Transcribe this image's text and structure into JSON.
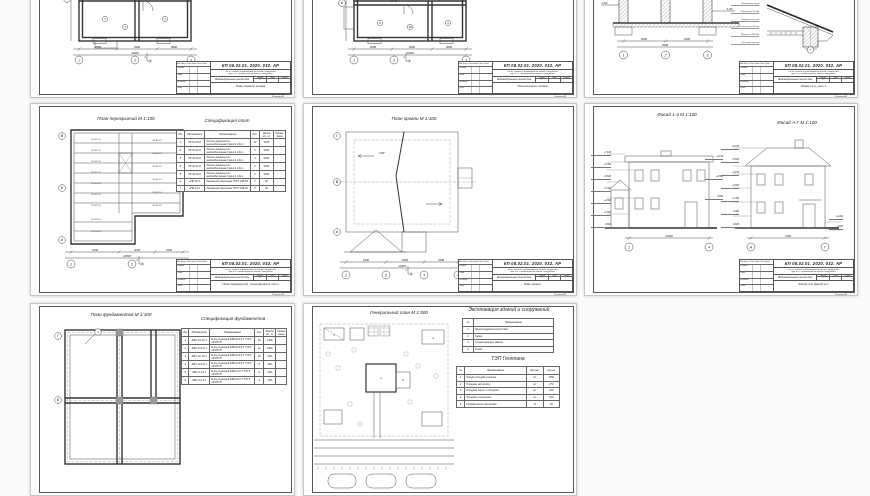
{
  "project": {
    "code": "КП 08.02.01. 2020. 032. АР",
    "discipline_line1": "ПМ.01 Участие в проектировании зданий и сооружений",
    "discipline_line2": "МДК 01.01 Проектирование зданий и сооружений",
    "object_name": "Индивидуальный жилой дом",
    "stage_label": "Стадия",
    "sheet_label": "Лист",
    "sheets_label": "Листов",
    "stage_value": "У",
    "format_label": "Формат А3",
    "sig_header": "Изм. Кол.уч. Лист №док. Подп. Дата",
    "sig_rows": [
      "Разраб.",
      "Пров.",
      "Н.контр.",
      "Утв."
    ]
  },
  "sheets": [
    {
      "id": "plan-floor-1",
      "doc_name": "План первого этажа",
      "grid_cols": [
        "1",
        "2",
        "3"
      ],
      "grid_rows": [
        "Б",
        "В"
      ],
      "room_numbers": [
        "1",
        "2",
        "3",
        "4",
        "5"
      ],
      "dims": [
        "4500",
        "2900",
        "3600"
      ],
      "dim_total": "11000",
      "section_mark": "1"
    },
    {
      "id": "plan-floor-2",
      "doc_name": "План второго этажа",
      "grid_cols": [
        "1",
        "2",
        "3"
      ],
      "grid_rows": [
        "Б",
        "В"
      ],
      "room_numbers": [
        "6",
        "7",
        "8",
        "9",
        "10"
      ],
      "dims": [
        "4500",
        "2900",
        "3600"
      ],
      "dim_total": "11000",
      "section_mark": "1"
    },
    {
      "id": "section-1-1",
      "doc_name": "Разрез 1-1, узел 1",
      "grid_cols": [
        "1",
        "2",
        "3"
      ],
      "elev_left": [
        "+5,640",
        "+3,300",
        "-1,940"
      ],
      "elev_right": [
        "+6,640",
        "+4,140",
        "+2,740",
        "-0,160"
      ],
      "dims": [
        "4500",
        "4400"
      ],
      "dim_total": "8900",
      "node_callouts": [
        "Металлочерепица",
        "Обрешётка 32х100",
        "Стропильная нога",
        "Утеплитель 150 мм",
        "Мауэрлат 150х150",
        "Подшивка карниза"
      ],
      "node_bubble": "Г"
    },
    {
      "id": "slabs-plan",
      "title": "План перекрытий М 1:100",
      "spec_title": "Спецификация плит",
      "doc_name": "План перекрытий, спецификация плит",
      "grid_cols": [
        "1",
        "2",
        "3"
      ],
      "grid_rows": [
        "В",
        "Б",
        "А"
      ],
      "dims": [
        "5180",
        "3220",
        "2400"
      ],
      "dim_total": "10800",
      "section_mark": "1",
      "slab_labels_left": [
        "ПК 51-15",
        "ПК 51-15",
        "ПК 51-15",
        "ПК 51-15",
        "ПК 51-15",
        "ПК 51-15",
        "ПК 51-15"
      ],
      "slab_labels_right": [
        "ПК 42-15",
        "ПК 42-15",
        "ПК 42-15",
        "ПК 42-12",
        "ПК 42-15",
        "ПК 42-15"
      ],
      "slab_labels_mid": [
        "ПК 51-12",
        "ПК 15-12"
      ],
      "spec": {
        "headers": [
          "Поз.",
          "Обозначение",
          "Наименование",
          "Кол.",
          "Масса ед., кг",
          "Приме- чание"
        ],
        "widths": [
          "7%",
          "19%",
          "42%",
          "8%",
          "13%",
          "11%"
        ],
        "rows": [
          [
            "1",
            "ПК 51-15-8",
            "Плита перекрытия железобетонная Серия 1.141-1",
            "12",
            "2150",
            ""
          ],
          [
            "2",
            "ПК 51-12-8",
            "Плита перекрытия железобетонная Серия 1.141-1",
            "6",
            "1800",
            ""
          ],
          [
            "3",
            "ПК 42-15-8",
            "Плита перекрытия железобетонная Серия 1.141-1",
            "4",
            "2050",
            ""
          ],
          [
            "4",
            "ПК 42-12-8",
            "Плита перекрытия железобетонная Серия 1.141-1",
            "2",
            "1650",
            ""
          ],
          [
            "5",
            "ПК 36-15-8",
            "Плита перекрытия железобетонная Серия 1.141-1",
            "2",
            "1500",
            ""
          ],
          [
            "6",
            "2ПБ 22-3",
            "Перемычка брусковая ГОСТ 948-84",
            "7",
            "92",
            ""
          ],
          [
            "7",
            "2ПБ 13-1",
            "Перемычка брусковая ГОСТ 948-84",
            "5",
            "54",
            ""
          ]
        ]
      }
    },
    {
      "id": "roof-plan",
      "title": "План кровли М 1:100",
      "doc_name": "План кровли",
      "grid_cols": [
        "1",
        "2",
        "3",
        "4"
      ],
      "grid_rows": [
        "Г",
        "В",
        "А"
      ],
      "dims": [
        "2400",
        "5200",
        "3400"
      ],
      "dim_total": "11000",
      "slope_label": "i=30°",
      "section_mark": "1"
    },
    {
      "id": "facades",
      "title_1": "Фасад 1-4 М 1:100",
      "title_2": "Фасад А-Г М 1:100",
      "doc_name": "Фасад 1-4, фасад А-Г",
      "elev_left_1": [
        "+7,100",
        "+6,390",
        "+5,600",
        "+3,300",
        "+2,800",
        "+1,500",
        "-0,600"
      ],
      "elev_right_1": [
        "+4,190",
        "+2,800",
        "0,000"
      ],
      "elev_left_2": [
        "+6,870",
        "+5,600",
        "+4,870",
        "+2,800",
        "+1,350",
        "0,000",
        "-0,600"
      ],
      "elev_right_2": [
        "+0,464",
        "-0,600"
      ],
      "bubbles_1": [
        "1",
        "4"
      ],
      "bubbles_2": [
        "А",
        "Г"
      ],
      "dim_1": "10900",
      "dim_2": "7300"
    },
    {
      "id": "foundations-plan",
      "title": "План фундаментов М 1:100",
      "spec_title": "Спецификация фундаментов",
      "grid_rows": [
        "Г",
        "Б"
      ],
      "detail_mark": "1",
      "spec": {
        "headers": [
          "Поз.",
          "Обозначение",
          "Наименование",
          "Кол.",
          "Масса ед., кг",
          "Приме- чание"
        ],
        "widths": [
          "7%",
          "20%",
          "43%",
          "8%",
          "12%",
          "10%"
        ],
        "rows": [
          [
            "1",
            "ФБС 24.4.6-Т",
            "Блок стеновой ФБС24.4.6-Т ГОСТ 13579-78",
            "46",
            "1300",
            ""
          ],
          [
            "2",
            "ФБС 24.6.6-Т",
            "Блок стеновой ФБС24.6.6-Т ГОСТ 13579-78",
            "12",
            "1960",
            ""
          ],
          [
            "3",
            "ФБС 12.4.6-Т",
            "Блок стеновой ФБС12.4.6-Т ГОСТ 13579-78",
            "18",
            "640",
            ""
          ],
          [
            "4",
            "ФБС 12.6.6-Т",
            "Блок стеновой ФБС12.6.6-Т ГОСТ 13579-78",
            "8",
            "960",
            ""
          ],
          [
            "5",
            "ФБС 9.4.6-Т",
            "Блок стеновой ФБС9.4.6-Т ГОСТ 13579-78",
            "6",
            "470",
            ""
          ],
          [
            "6",
            "ФБС 9.6.6-Т",
            "Блок стеновой ФБС9.6.6-Т ГОСТ 13579-78",
            "4",
            "700",
            ""
          ]
        ]
      }
    },
    {
      "id": "genplan",
      "title": "Генеральный план М 1:500",
      "explic_title": "Экспликация зданий и сооружений",
      "tep_title": "ТЭП Генплана",
      "explic": {
        "headers": [
          "№",
          "Наименование"
        ],
        "widths": [
          "12%",
          "88%"
        ],
        "rows": [
          [
            "1",
            "Проектируемый жилой дом"
          ],
          [
            "2",
            "Гараж"
          ],
          [
            "3",
            "Существующее здание"
          ],
          [
            "4",
            "Склад"
          ]
        ]
      },
      "tep": {
        "headers": [
          "№",
          "Наименование",
          "Ед.изм.",
          "Кол-во"
        ],
        "widths": [
          "8%",
          "60%",
          "16%",
          "16%"
        ],
        "rows": [
          [
            "1",
            "Общая площадь участка",
            "м²",
            "1500"
          ],
          [
            "2",
            "Площадь застройки",
            "м²",
            "270"
          ],
          [
            "3",
            "Площадь дорог и площадок",
            "м²",
            "420"
          ],
          [
            "4",
            "Площадь озеленения",
            "м²",
            "810"
          ],
          [
            "5",
            "Коэффициент застройки",
            "%",
            "18"
          ]
        ]
      }
    }
  ]
}
